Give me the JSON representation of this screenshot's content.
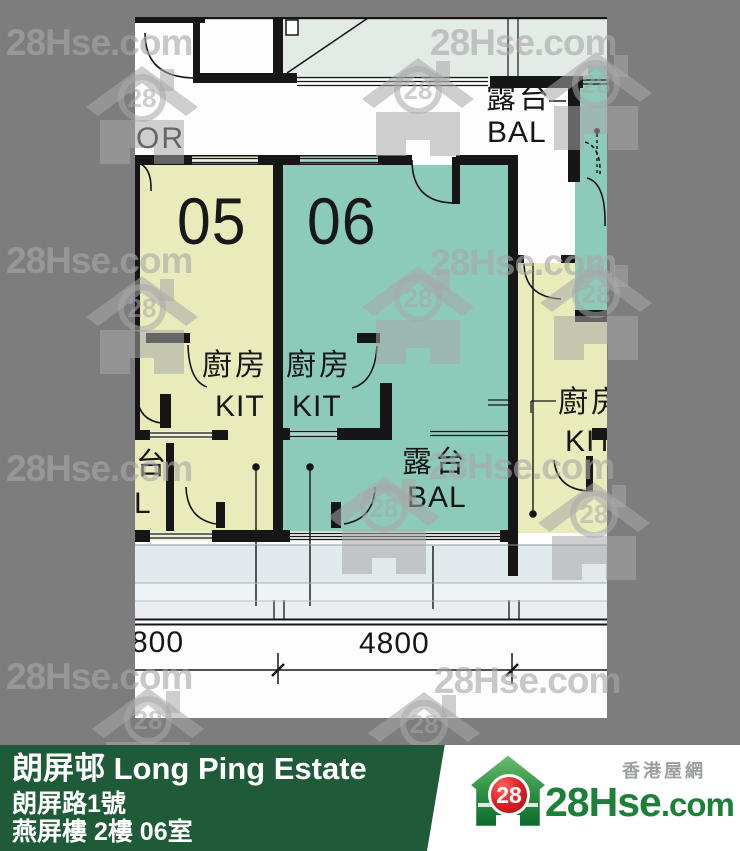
{
  "page": {
    "width": 740,
    "height": 851,
    "background": "#7d7d7d"
  },
  "watermark": {
    "text": "28Hse.com",
    "badge": "28"
  },
  "plan": {
    "corridor_label": "OR",
    "unit_numbers": {
      "left": "05",
      "right": "06"
    },
    "rooms": {
      "kitchen_cn": "廚房",
      "kitchen_en": "KIT",
      "balcony_cn": "露台",
      "balcony_en": "BAL"
    },
    "dimensions": {
      "left": "800",
      "right": "4800"
    },
    "colors": {
      "unit05": "#e9ecba",
      "unit06": "#8ccbb9",
      "pale_room": "#e3ebe6",
      "wall": "#161616"
    }
  },
  "footer": {
    "estate": "朗屏邨 Long Ping Estate",
    "address": "朗屏路1號",
    "flat": "燕屏樓 2樓 06室",
    "logo": {
      "badge": "28",
      "brand": "28Hse",
      "suffix": ".com",
      "tagline": "香港屋網"
    },
    "colors": {
      "bar_green": "#1f5b38",
      "badge_red": "#d91c22",
      "brand_green": "#1e8038"
    }
  }
}
